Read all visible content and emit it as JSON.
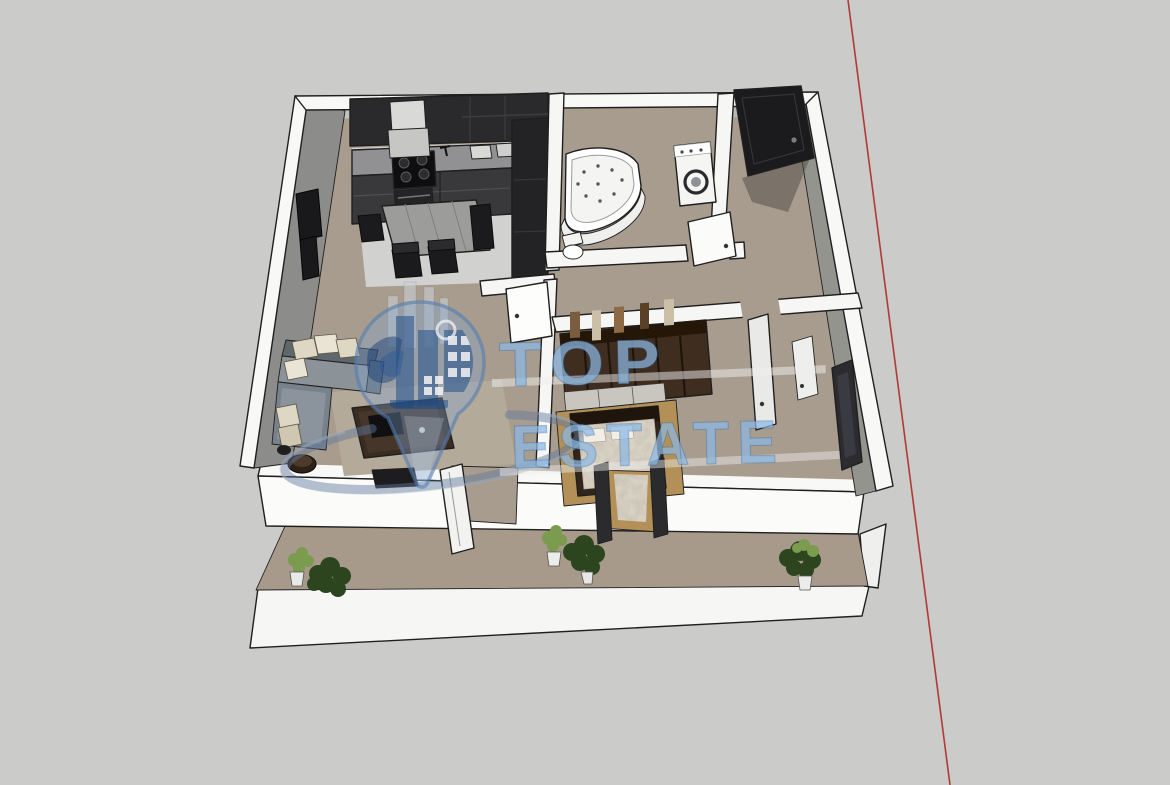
{
  "watermark": {
    "title": "TOP",
    "subtitle": "ESTATE"
  },
  "colors": {
    "background": "#cbcbc9",
    "axis_line": "#b03a36",
    "floor": "#a89c8e",
    "balcony_floor": "#a79a8b",
    "kitchen_floor": "#d1d1cf",
    "wall": "#f8f8f6",
    "wall_shadow": "#8c8c8a",
    "watermark_blue": "#8db8e4",
    "watermark_dark_blue": "#2f6da8",
    "kitchen_dark": "#2a2a2c",
    "sofa_gray": "#8b9298",
    "wood": "#b29057",
    "plant_dark": "#2c451f",
    "plant_light": "#7b9b4e"
  }
}
